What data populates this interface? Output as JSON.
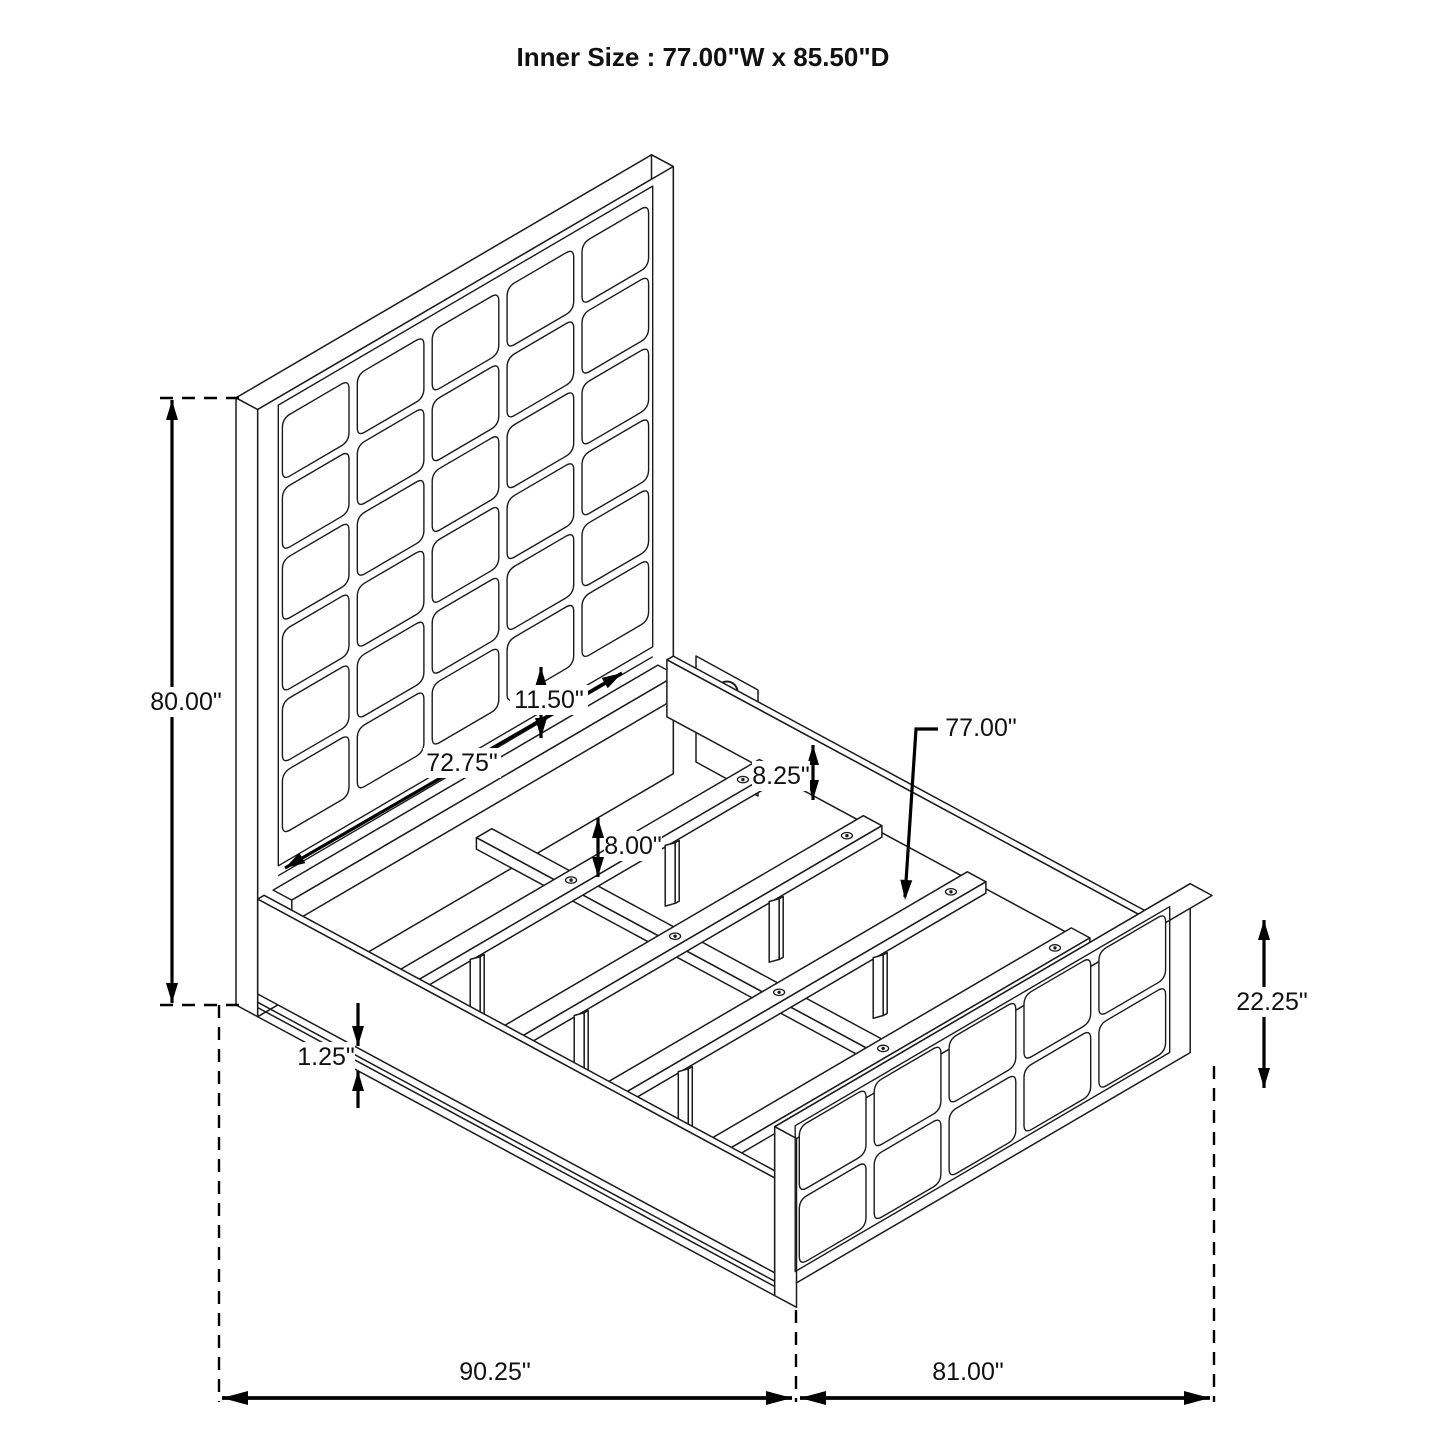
{
  "title": "Inner Size : 77.00\"W x 85.50\"D",
  "dimensions": {
    "headboard_height": "80.00\"",
    "headboard_inner_width": "72.75\"",
    "panel_to_rail_gap": "11.50\"",
    "rail_top_to_slat": "8.25\"",
    "slat_leg_height": "8.00\"",
    "slat_length": "77.00\"",
    "footboard_height": "22.25\"",
    "base_rail_thickness": "1.25\"",
    "overall_depth": "90.25\"",
    "overall_width": "81.00\""
  }
}
